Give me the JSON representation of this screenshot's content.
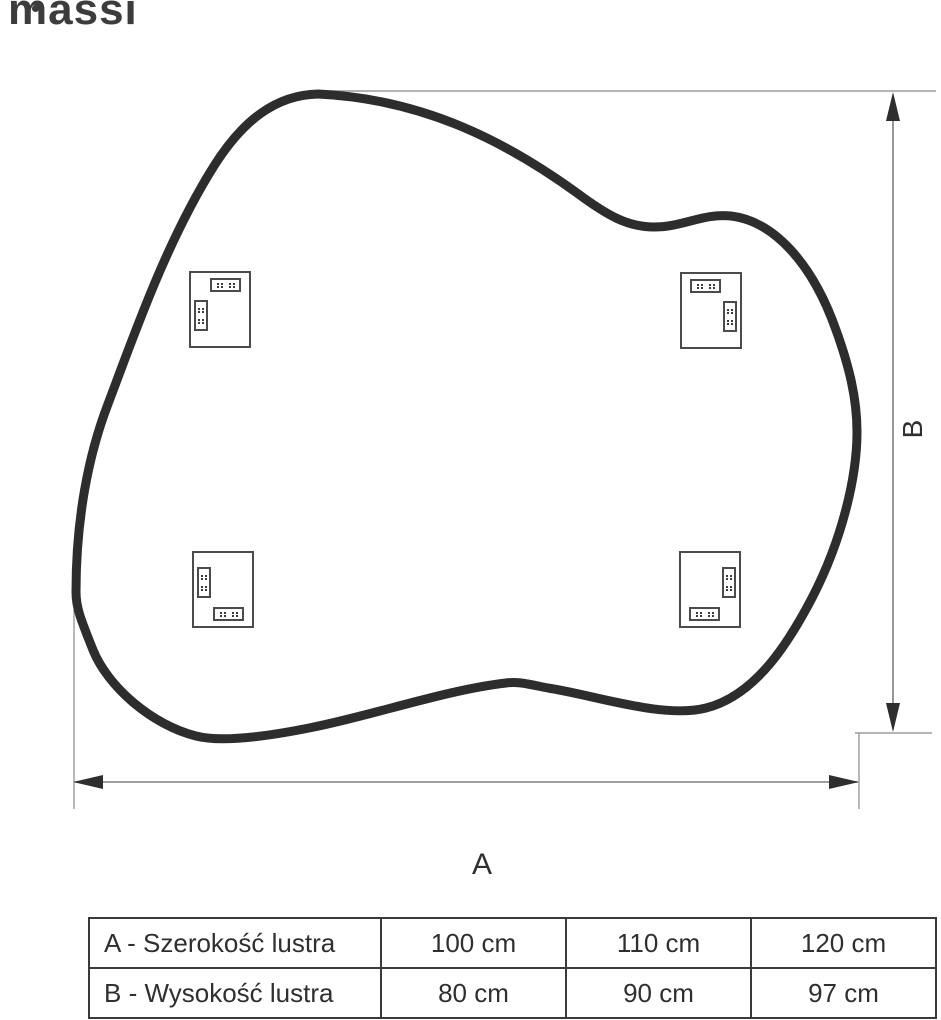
{
  "brand": {
    "logo_text": "massi"
  },
  "diagram": {
    "width_label": "A",
    "height_label": "B",
    "shape": "organic-blob-mirror-outline",
    "mounting_brackets_count": 4
  },
  "table": {
    "rows": [
      {
        "label": "A - Szerokość lustra",
        "values": [
          "100 cm",
          "110 cm",
          "120 cm"
        ]
      },
      {
        "label": "B - Wysokość lustra",
        "values": [
          "80 cm",
          "90 cm",
          "97 cm"
        ]
      }
    ]
  },
  "colors": {
    "outline": "#2d2d2d",
    "dimension_line": "#7d7d7d",
    "extension_line": "#9b9b9b",
    "arrow": "#2e2e2e",
    "text": "#2f2f2f"
  }
}
